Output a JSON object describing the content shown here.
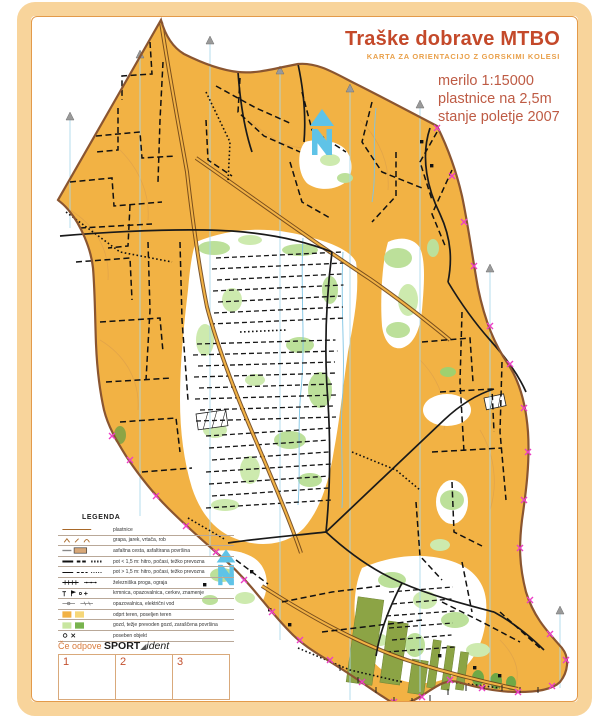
{
  "header": {
    "title": "Traške dobrave MTBO",
    "subtitle": "KARTA ZA ORIENTACIJO Z GORSKIMI KOLESI",
    "scale": "merilo 1:15000",
    "contour_interval": "plastnice na 2,5m",
    "status": "stanje poletje 2007"
  },
  "legend": {
    "title": "LEGENDA",
    "rows": [
      {
        "symbol": "contour-line-icon",
        "label": "plastnice"
      },
      {
        "symbol": "landform-icons",
        "label": "grapa, jarek, vrtača, rob"
      },
      {
        "symbol": "asphalt-road-icon",
        "label": "asfaltna cesta, asfaltirana površina"
      },
      {
        "symbol": "wide-path-icons",
        "label": "pot < 1,5 m: hitro, počasi, težko prevozna"
      },
      {
        "symbol": "narrow-path-icons",
        "label": "pot > 1,5 m: hitro, počasi, težko prevozna"
      },
      {
        "symbol": "railway-fence-icons",
        "label": "železniška proga, ograja"
      },
      {
        "symbol": "point-feature-icons",
        "label": "krmnica, opazovalnica, cerkev, znamenje"
      },
      {
        "symbol": "powerline-icons",
        "label": "opazovalnica, električni vod"
      },
      {
        "symbol": "open-land-swatches",
        "label": "odprt teren, poseljen teren"
      },
      {
        "symbol": "forest-swatches",
        "label": "gozd, težje prevoden gozd, zaraščena površina"
      },
      {
        "symbol": "special-object-icons",
        "label": "poseben objekt"
      }
    ]
  },
  "sportident": {
    "prefix": "Če odpove ",
    "brand_bold": "SPORT",
    "brand_triangle": "◢",
    "brand_italic": "ident",
    "cells": [
      "1",
      "2",
      "3"
    ]
  },
  "colors": {
    "terrain_open_orange": "#F2B244",
    "frame_peach": "#F8D49B",
    "frame_line": "#E39A4A",
    "title_red": "#C4492A",
    "subtitle_orange": "#E9A04A",
    "info_brick": "#BE5B44",
    "boundary_brown": "#8A5530",
    "north_line_blue": "#A8D8EC",
    "north_arrow_blue": "#5FC3E7",
    "edge_mark_magenta": "#EC3FC6",
    "forest_white": "#FFFFFF",
    "vegetation_green": "#BCE09A",
    "vineyard_olive": "#8CA445",
    "trail_black": "#161616"
  }
}
